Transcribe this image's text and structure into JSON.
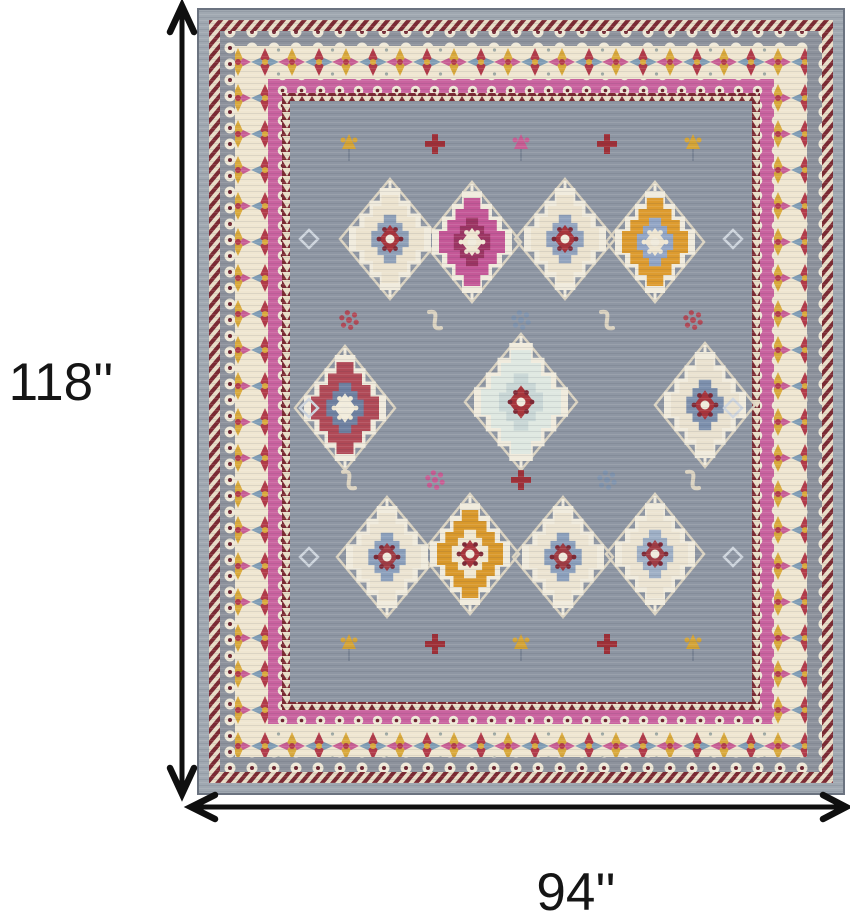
{
  "figure": {
    "description": "Product dimension diagram of a gray, ivory and pink ornamental oriental area rug",
    "height_label": "118''",
    "width_label": "94''"
  },
  "palette": {
    "background": "#ffffff",
    "dimensionLine": "#0f0f0f",
    "outerBand": "#a0a8b1",
    "outerEdge": "#6b7380",
    "maroon": "#7c2a33",
    "zigCream": "#e8ddc7",
    "grayBand": "#8d929c",
    "rosetteCream": "#efe9d8",
    "rosetteDot": "#6e2430",
    "creamBand": "#efe6d1",
    "flowerRed": "#b23b4a",
    "flowerBlue": "#7f9cb4",
    "flowerGold": "#d9a93c",
    "flowerMagenta": "#c75d93",
    "leafGray": "#9aa5a0",
    "pinkBand": "#c9639f",
    "field": "#8e96a3",
    "lattice": "#ddd5c3",
    "medallionOutline": "#f0ebdd"
  },
  "rug": {
    "medallions": [
      {
        "x": 193,
        "y": 231,
        "rx": 34,
        "ry": 44,
        "main": "#ece3cf",
        "inner": "#8fa0b8",
        "center": "#a8343c",
        "dot": "#7e2936"
      },
      {
        "x": 275,
        "y": 234,
        "rx": 33,
        "ry": 44,
        "main": "#c45897",
        "inner": "#9c3563",
        "center": "#efe6d2",
        "dot": "#f0e8d4"
      },
      {
        "x": 368,
        "y": 231,
        "rx": 34,
        "ry": 44,
        "main": "#ece3cf",
        "inner": "#92a3bd",
        "center": "#a8343c",
        "dot": "#7e2936"
      },
      {
        "x": 458,
        "y": 234,
        "rx": 33,
        "ry": 44,
        "main": "#dd9b2f",
        "inner": "#93a6c6",
        "center": "#efe6d2",
        "dot": "#f0e8d4"
      },
      {
        "x": 148,
        "y": 400,
        "rx": 34,
        "ry": 46,
        "main": "#b04a57",
        "inner": "#6f81a1",
        "center": "#f2ecdc",
        "dot": "#f0e8d4"
      },
      {
        "x": 324,
        "y": 394,
        "rx": 40,
        "ry": 52,
        "main": "#dfe8e1",
        "inner": "#c9d7d6",
        "center": "#a8353b",
        "dot": "#7e2936"
      },
      {
        "x": 508,
        "y": 397,
        "rx": 34,
        "ry": 46,
        "main": "#eae2d0",
        "inner": "#7d90ad",
        "center": "#a8343c",
        "dot": "#7e2936"
      },
      {
        "x": 190,
        "y": 549,
        "rx": 34,
        "ry": 44,
        "main": "#ece4d2",
        "inner": "#8ca0bc",
        "center": "#a03c44",
        "dot": "#7e2936"
      },
      {
        "x": 273,
        "y": 546,
        "rx": 33,
        "ry": 44,
        "main": "#d9992c",
        "inner": "#f0e8d2",
        "center": "#a8343c",
        "dot": "#7e2936"
      },
      {
        "x": 366,
        "y": 549,
        "rx": 34,
        "ry": 44,
        "main": "#ece4d2",
        "inner": "#8ca0bc",
        "center": "#a03c44",
        "dot": "#7e2936"
      },
      {
        "x": 458,
        "y": 546,
        "rx": 33,
        "ry": 44,
        "main": "#ece4d2",
        "inner": "#9fb0c6",
        "center": "#a03c44",
        "dot": "#7e2936"
      }
    ],
    "motifs": [
      {
        "t": "tulip",
        "x": 152,
        "y": 136,
        "c": "#d4a437"
      },
      {
        "t": "cross",
        "x": 238,
        "y": 136,
        "c": "#9e3038"
      },
      {
        "t": "tulip",
        "x": 324,
        "y": 136,
        "c": "#c75d93"
      },
      {
        "t": "cross",
        "x": 410,
        "y": 136,
        "c": "#9e3038"
      },
      {
        "t": "tulip",
        "x": 496,
        "y": 136,
        "c": "#d4a437"
      },
      {
        "t": "dots",
        "x": 152,
        "y": 312,
        "c": "#b04a57"
      },
      {
        "t": "sshape",
        "x": 238,
        "y": 312,
        "c": "#dcd4c2"
      },
      {
        "t": "dots",
        "x": 324,
        "y": 312,
        "c": "#7f93ad"
      },
      {
        "t": "sshape",
        "x": 410,
        "y": 312,
        "c": "#dcd4c2"
      },
      {
        "t": "dots",
        "x": 496,
        "y": 312,
        "c": "#b04a57"
      },
      {
        "t": "sshape",
        "x": 152,
        "y": 472,
        "c": "#dcd4c2"
      },
      {
        "t": "dots",
        "x": 238,
        "y": 472,
        "c": "#c75d93"
      },
      {
        "t": "cross",
        "x": 324,
        "y": 472,
        "c": "#9e3038"
      },
      {
        "t": "dots",
        "x": 410,
        "y": 472,
        "c": "#7f93ad"
      },
      {
        "t": "sshape",
        "x": 496,
        "y": 472,
        "c": "#dcd4c2"
      },
      {
        "t": "tulip",
        "x": 152,
        "y": 636,
        "c": "#d4a437"
      },
      {
        "t": "cross",
        "x": 238,
        "y": 636,
        "c": "#9e3038"
      },
      {
        "t": "tulip",
        "x": 324,
        "y": 636,
        "c": "#d4a437"
      },
      {
        "t": "cross",
        "x": 410,
        "y": 636,
        "c": "#9e3038"
      },
      {
        "t": "tulip",
        "x": 496,
        "y": 636,
        "c": "#d4a437"
      },
      {
        "t": "diamond",
        "x": 112,
        "y": 231,
        "c": "#cfd6de"
      },
      {
        "t": "diamond",
        "x": 112,
        "y": 400,
        "c": "#cfd6de"
      },
      {
        "t": "diamond",
        "x": 112,
        "y": 549,
        "c": "#cfd6de"
      },
      {
        "t": "diamond",
        "x": 536,
        "y": 231,
        "c": "#cfd6de"
      },
      {
        "t": "diamond",
        "x": 536,
        "y": 400,
        "c": "#cfd6de"
      },
      {
        "t": "diamond",
        "x": 536,
        "y": 549,
        "c": "#cfd6de"
      }
    ]
  }
}
